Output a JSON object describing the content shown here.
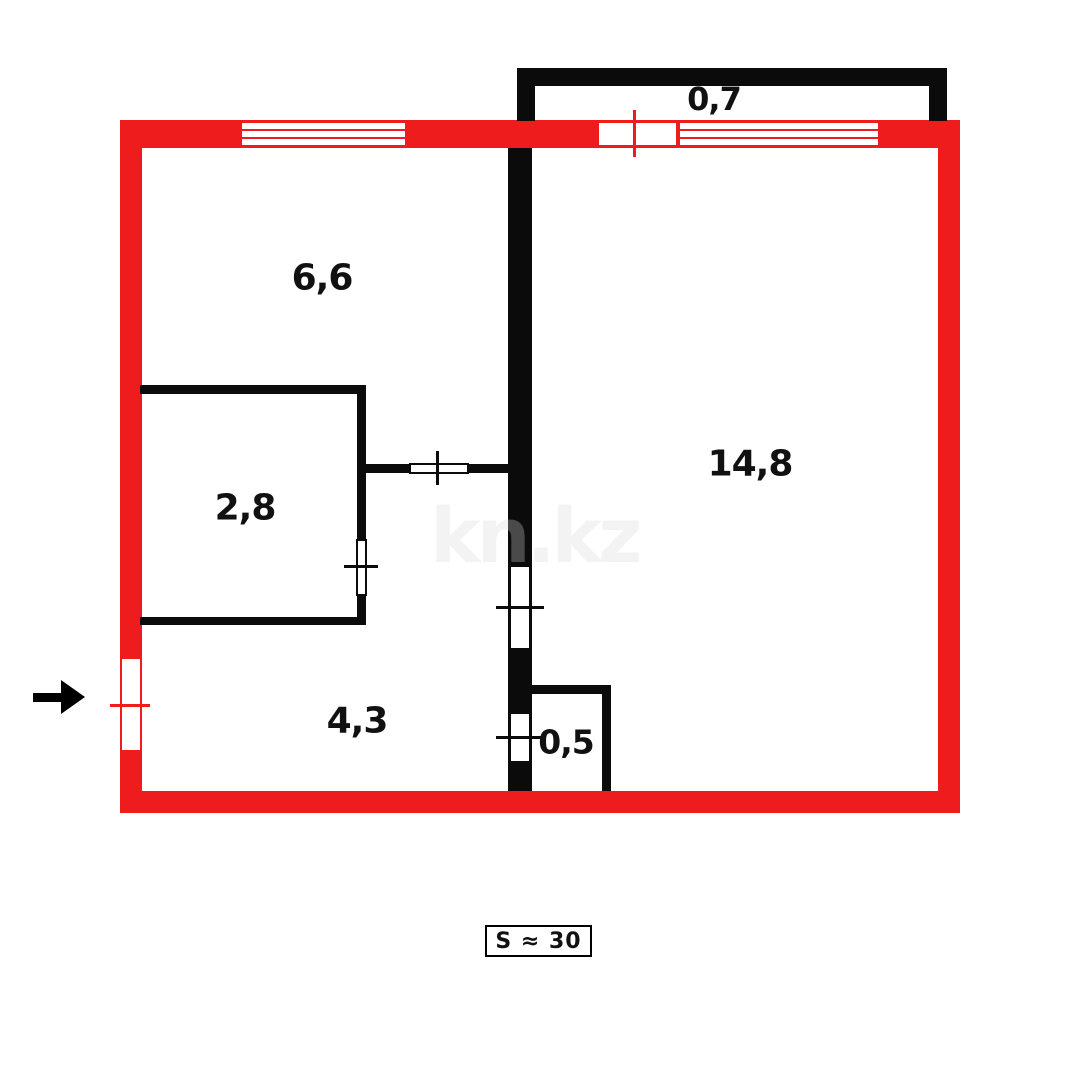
{
  "floorplan": {
    "watermark": "kn.kz",
    "total_area_label": "S ≈ 30",
    "rooms": [
      {
        "name": "balcony",
        "area_label": "0,7"
      },
      {
        "name": "kitchen",
        "area_label": "6,6"
      },
      {
        "name": "living-room",
        "area_label": "14,8"
      },
      {
        "name": "bathroom",
        "area_label": "2,8"
      },
      {
        "name": "hallway",
        "area_label": "4,3"
      },
      {
        "name": "closet",
        "area_label": "0,5"
      }
    ],
    "colors": {
      "outer_wall_red": "#ee1c1c",
      "inner_wall_black": "#0b0b0b",
      "watermark_light": "#f3f3f3",
      "watermark_dark": "#4a4a4a",
      "label_black": "#111111"
    }
  }
}
